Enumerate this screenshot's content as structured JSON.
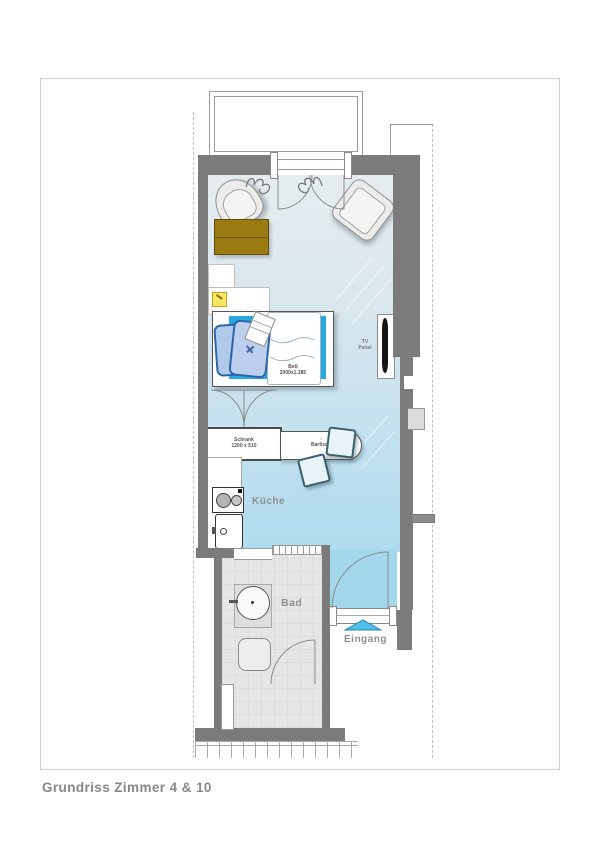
{
  "title": "Grundriss Zimmer 4 & 10",
  "rooms": {
    "kitchen": "Küche",
    "bath": "Bad",
    "entrance": "Eingang"
  },
  "furniture": {
    "bed": {
      "name": "Bett",
      "size": "2000x1.385"
    },
    "wardrobe": {
      "name": "Schrank",
      "size": "1200 x 510"
    },
    "bar_table": {
      "name": "Bartisch"
    },
    "tv": {
      "line1": "TV",
      "line2": "Panel"
    }
  },
  "colors": {
    "wall": "#7b7b7b",
    "floor_top": "#e4ecef",
    "floor_bottom": "#a6d8ec",
    "bath_floor": "#e6e6e6",
    "mattress": "#27a9e0",
    "pillow": "#b0cbea",
    "pillow_border": "#2e65a8",
    "table_gold": "#9b7a12",
    "label": "#8f8f8f",
    "arrow": "#4fc0ea",
    "lamp": "#f5e868"
  }
}
